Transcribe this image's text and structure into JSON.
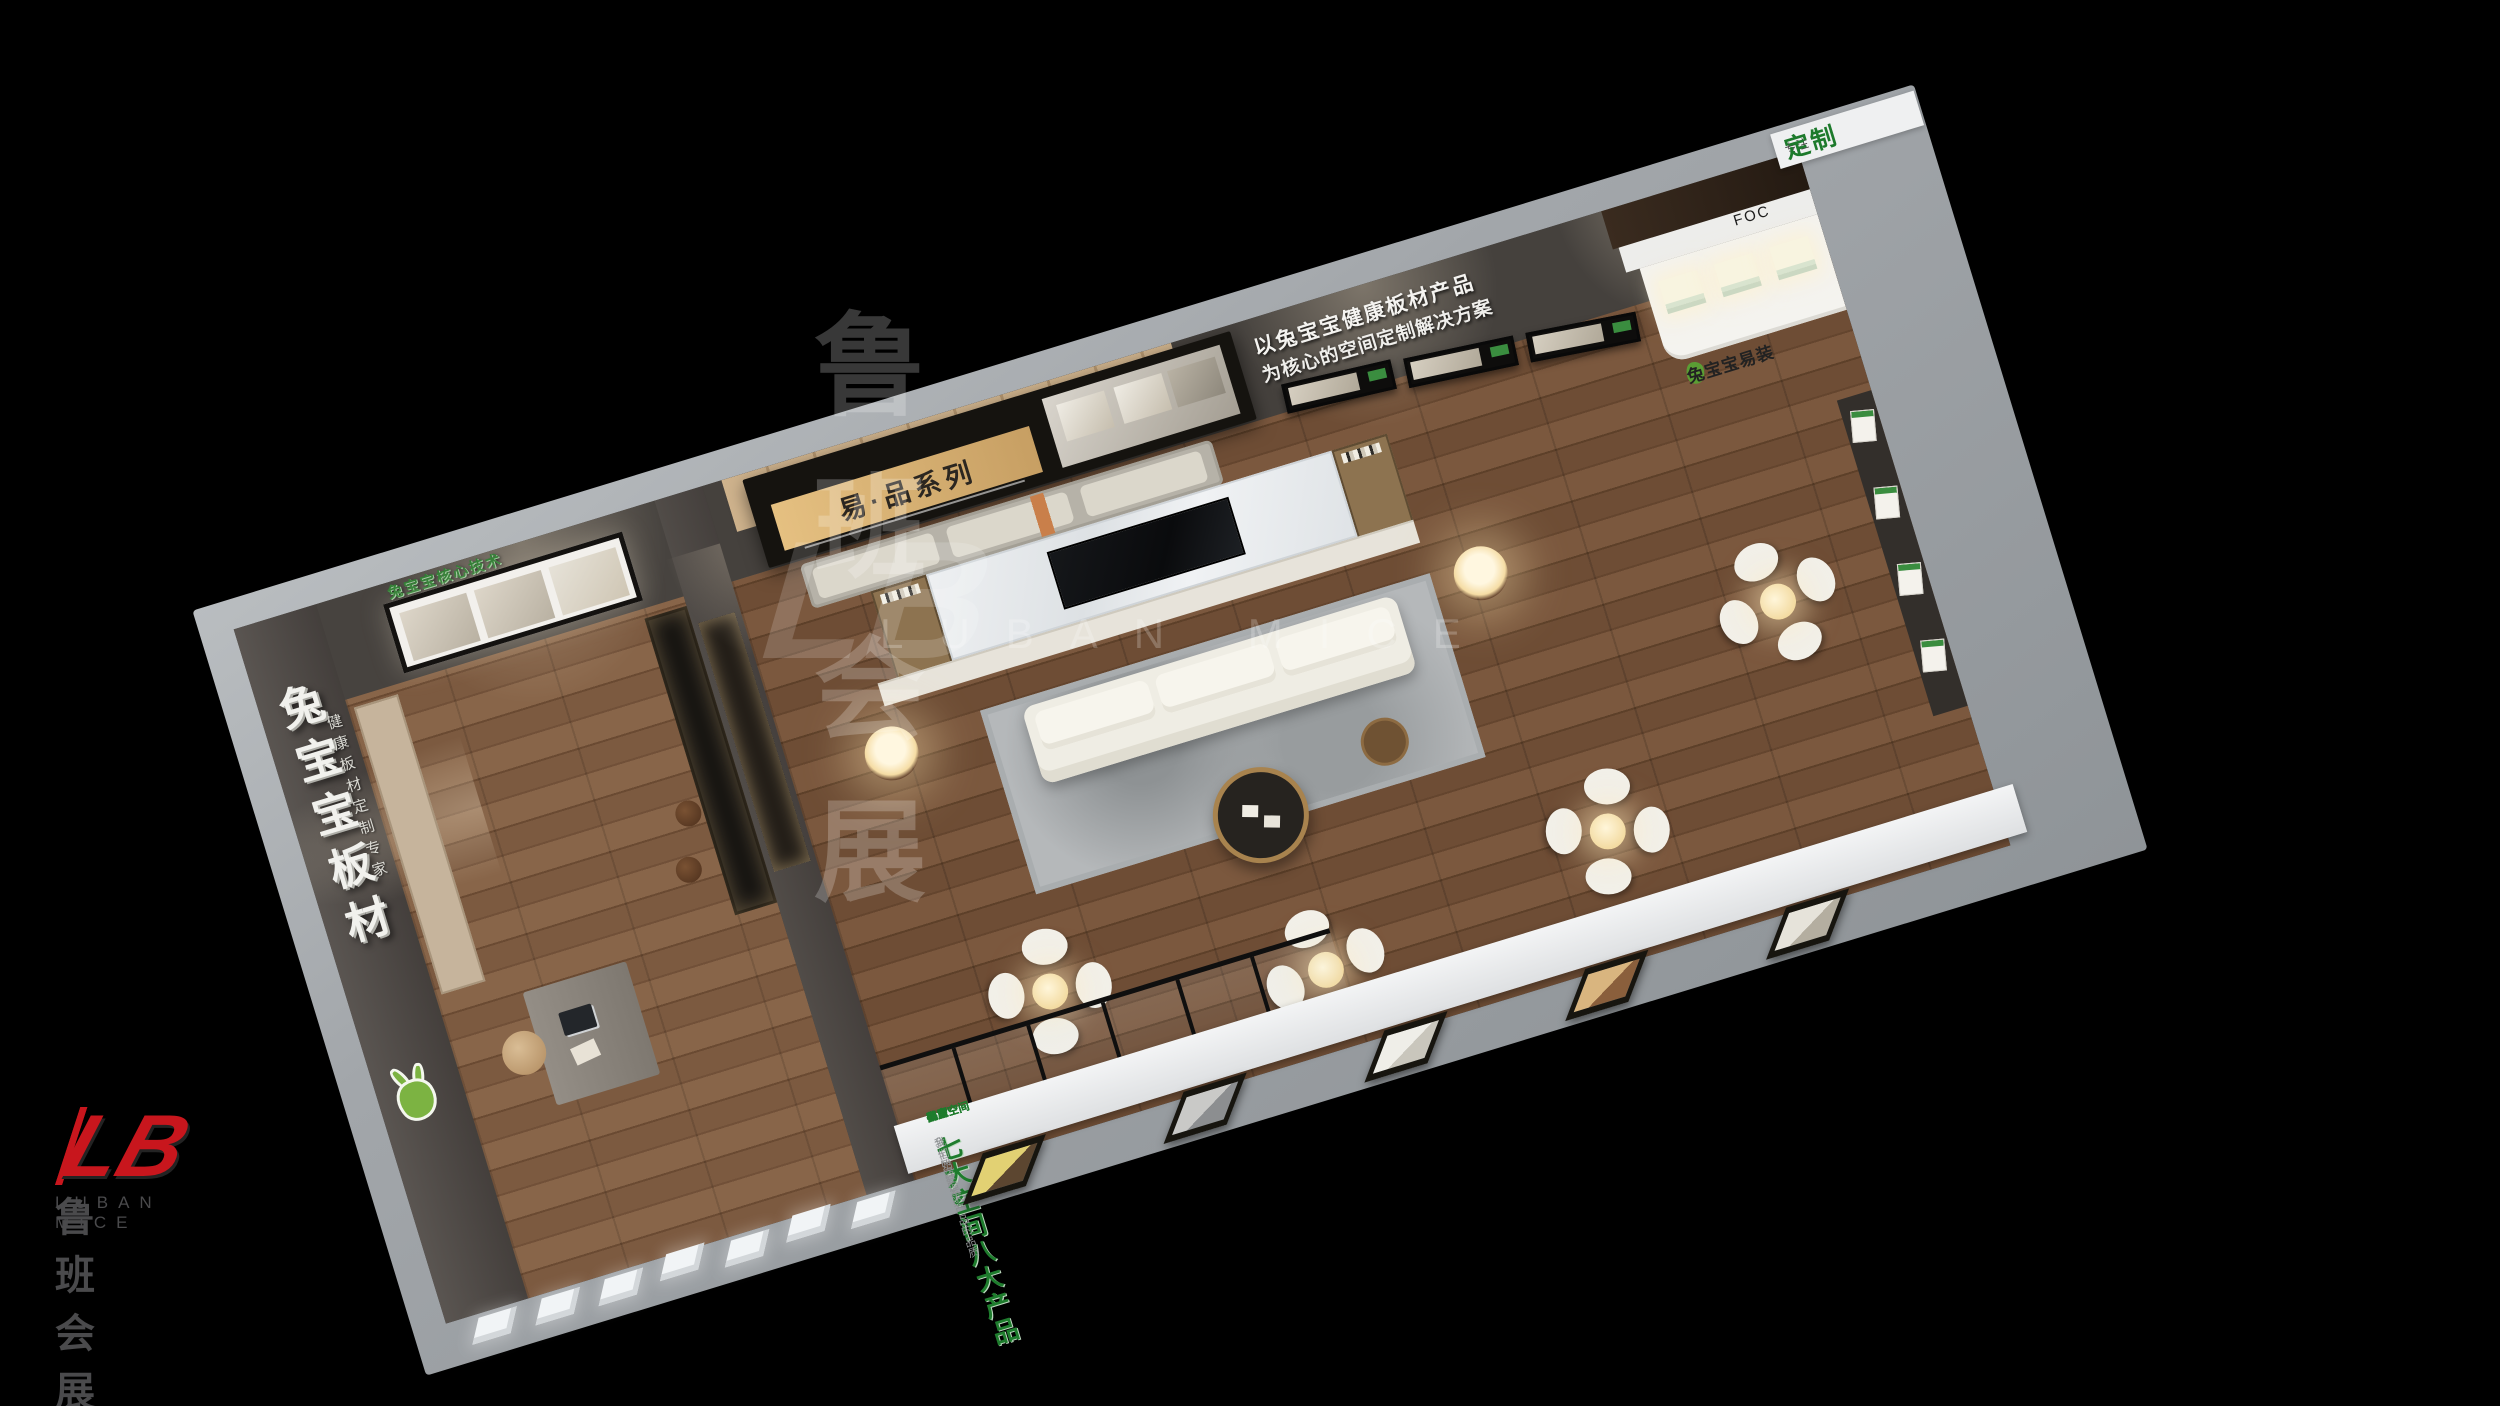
{
  "watermark": {
    "mark": "LB",
    "brand_cn": "鲁班会展",
    "brand_en": "LUBAN MICE"
  },
  "corner_logo": {
    "mark": "LB",
    "brand_cn": "鲁班会展",
    "brand_en": "LUBAN MICE"
  },
  "booth": {
    "far_wall": {
      "slogan_line1": "以兔宝宝健康板材产品",
      "slogan_line2": "为核心的空间定制解决方案",
      "series_banner": "易·品系列",
      "corner_sign_small": "专注",
      "corner_sign_big": "定制"
    },
    "counter": {
      "top_label": "FOC",
      "brand": "兔宝宝易装"
    },
    "front_beam": {
      "pre_title": "全空间定制系统",
      "title": "七大空间八大产品",
      "subtitle": "我们始终追求产品的品质",
      "spaces": [
        "入户空间",
        "卧室空间",
        "客厅空间",
        "书房空间",
        "儿童空间",
        "餐厨空间",
        "阳台空间"
      ]
    },
    "left_room": {
      "wall_text_big": "兔宝宝板材",
      "wall_text_small": "健康板材定制专家",
      "lightbox_slogan": "兔宝宝核心技术"
    }
  },
  "colors": {
    "brand_green": "#1e7c2d",
    "logo_red": "#c8161d",
    "banner_gold": "#d9b377",
    "background": "#000000"
  }
}
